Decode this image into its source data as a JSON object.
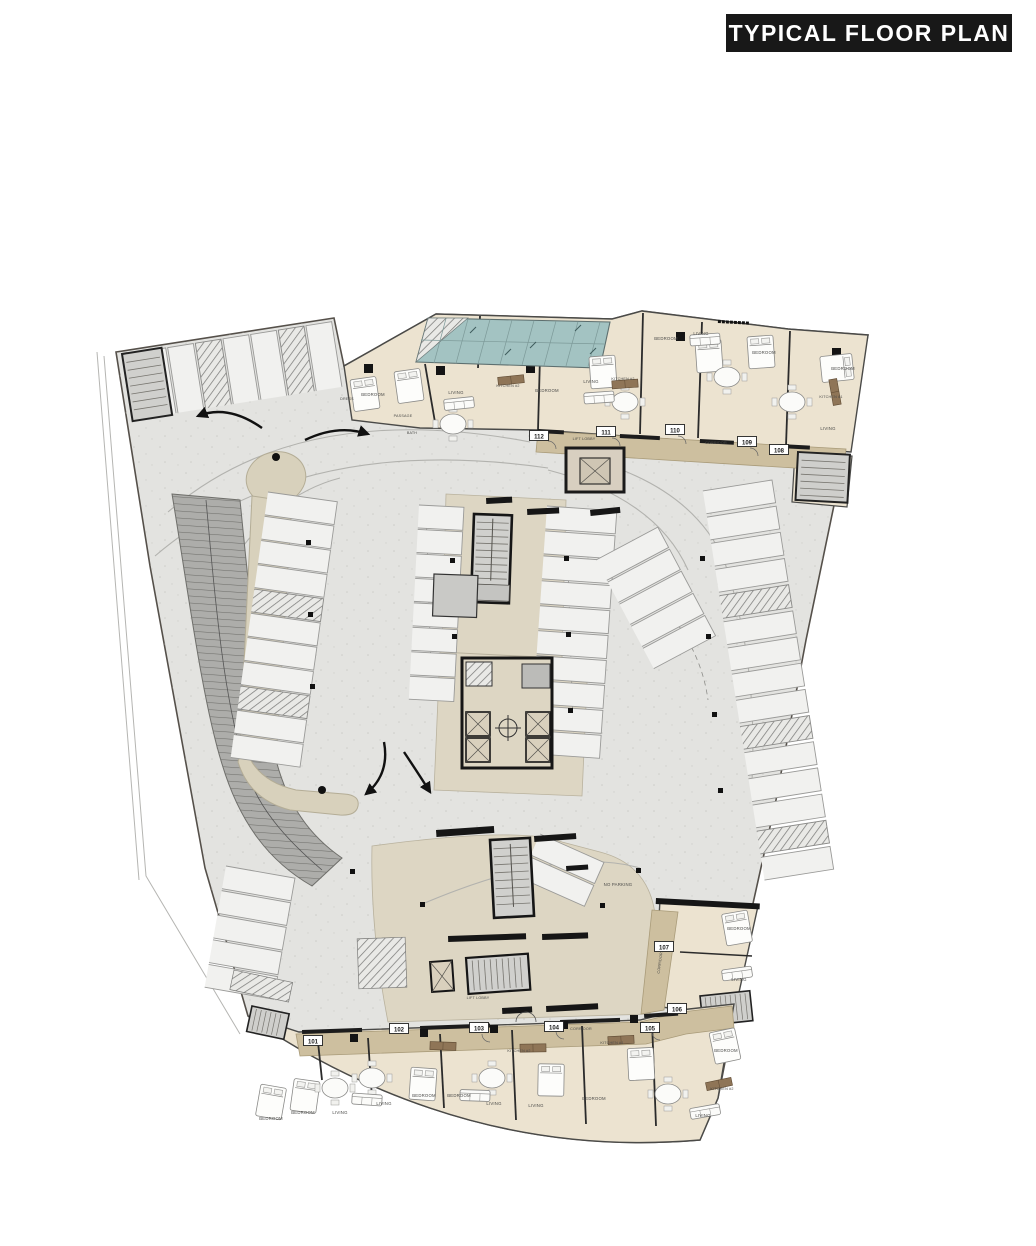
{
  "title": "TYPICAL FLOOR PLAN",
  "colors": {
    "title_bg": "#181818",
    "title_text": "#ffffff",
    "parking_floor": "#e3e3e0",
    "apartment_floor": "#ece3d0",
    "corridor_floor": "#cdbf9f",
    "drive_apron": "#ddd6c3",
    "skylight_teal": "#a3c3c2",
    "ramp_gray": "#adadaa",
    "wall_dark": "#2b2b2b"
  },
  "units": {
    "u101": "101",
    "u102": "102",
    "u103": "103",
    "u104": "104",
    "u105": "105",
    "u106": "106",
    "u107": "107",
    "u108": "108",
    "u109": "109",
    "u110": "110",
    "u111": "111",
    "u112": "112"
  },
  "labels": {
    "lift_lobby": "LIFT LOBBY",
    "corridor": "CORRIDOR",
    "no_parking": "NO PARKING",
    "bedroom": "BEDROOM",
    "living": "LIVING",
    "kitchen2": "KITCHEN #2",
    "kitchen1": "KITCHEN #1",
    "passage": "PASSAGE",
    "dress": "DRESS",
    "bath": "BATH"
  }
}
